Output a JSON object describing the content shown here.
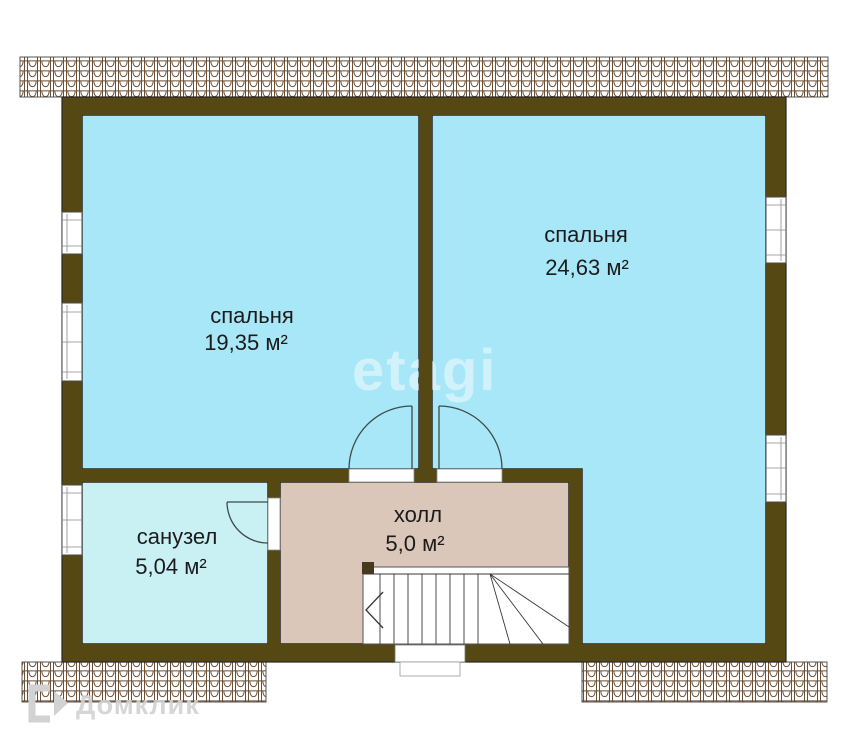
{
  "rooms": {
    "bedroom_left": {
      "name": "спальня",
      "area": "19,35 м²"
    },
    "bedroom_right": {
      "name": "спальня",
      "area": "24,63 м²"
    },
    "bathroom": {
      "name": "санузел",
      "area": "5,04 м²"
    },
    "hall": {
      "name": "холл",
      "area": "5,0 м²"
    }
  },
  "watermarks": {
    "center": "etagi",
    "corner": "Домклик"
  },
  "colors": {
    "wall": "#564813",
    "bedroom_fill": "#a8e7f8",
    "bathroom_fill": "#c9f1f4",
    "hall_fill": "#dbc7ba",
    "roof_tile_line": "#6d4f35",
    "room_outline": "#262626",
    "label_text": "#1b1b1b",
    "watermark_center": "rgba(255,255,255,0.47)",
    "watermark_corner": "#d2d2d2"
  }
}
